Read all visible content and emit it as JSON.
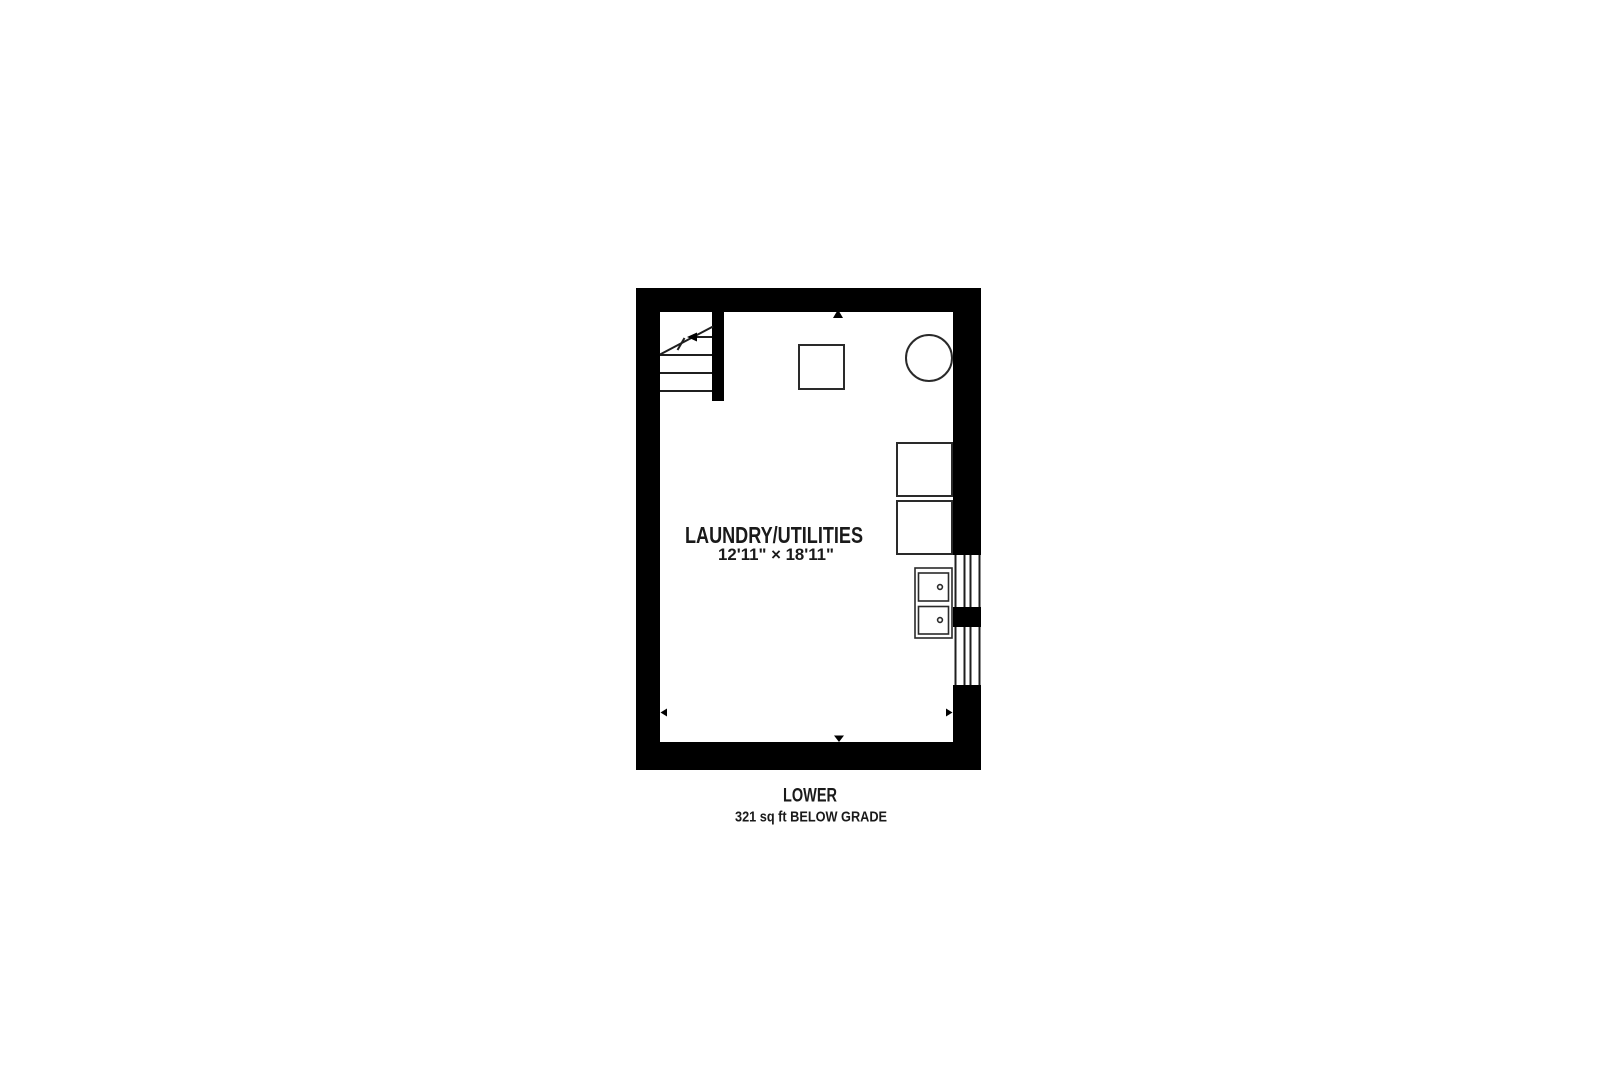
{
  "floorplan": {
    "room": {
      "name": "LAUNDRY/UTILITIES",
      "dimensions": "12'11\" × 18'11\""
    },
    "caption": {
      "level_label": "LOWER",
      "area_label": "321 sq ft BELOW GRADE"
    },
    "fixtures": [
      "stairs",
      "furnace",
      "water-heater-tank",
      "washer",
      "dryer",
      "laundry-sink",
      "window"
    ],
    "colors": {
      "walls": "#000000",
      "lines": "#1f1f1f",
      "text": "#1a1a1a",
      "background": "#ffffff"
    }
  }
}
